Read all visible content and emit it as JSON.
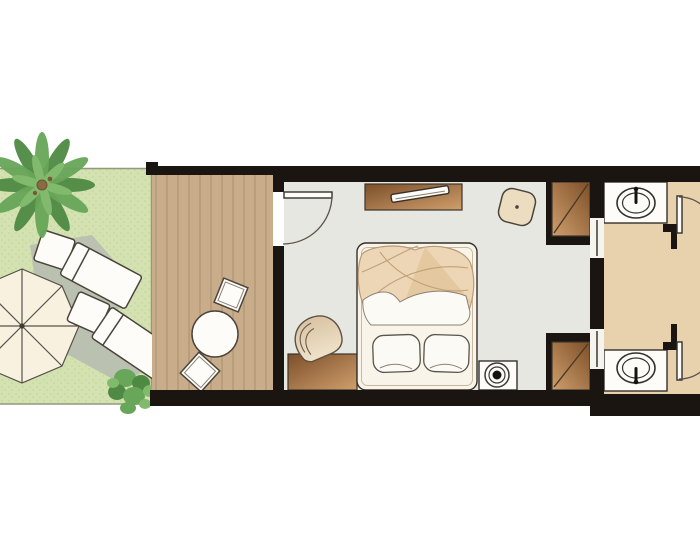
{
  "meta": {
    "type": "hotel-room-floor-plan",
    "width": 700,
    "height": 560,
    "visible_text": ""
  },
  "colors": {
    "background": "#ffffff",
    "wall": "#1b1512",
    "garden": "#d3e2b0",
    "garden_dot": "#c3d69c",
    "garden_edge": "#8f9b7e",
    "deck": "#c9ad8a",
    "deck_plank_line": "#a8906e",
    "bedroom_floor": "#e6e7e0",
    "bathroom_floor": "#e8d2ae",
    "furniture_dark": "#7d4f29",
    "furniture_light": "#cf9f6c",
    "bed_base": "#f8f4ea",
    "duvet": "#ecd6b6",
    "duvet_fold": "#e3c59c",
    "linen_white": "#fcfaf4",
    "white_furniture": "#fdfcf8",
    "chair_dark": "#d9c3a2",
    "chair_light": "#f0e3cc",
    "pouf": "#ecdcc0",
    "parasol": "#f8f1df",
    "shadow": "#b9beb2",
    "palm_dark": "#4f8a44",
    "palm_mid": "#68a659",
    "palm_light": "#82ba6d",
    "trunk": "#8a6a42",
    "panel_gap": "#f6f4ef",
    "lamp_black": "#151310"
  },
  "rooms": [
    {
      "name": "garden"
    },
    {
      "name": "deck-terrace"
    },
    {
      "name": "bedroom"
    },
    {
      "name": "bathroom-top"
    },
    {
      "name": "bathroom-bottom"
    }
  ],
  "furniture": [
    {
      "name": "palm-tree",
      "room": "garden"
    },
    {
      "name": "parasol-umbrella",
      "room": "garden"
    },
    {
      "name": "sun-lounger-1",
      "room": "garden"
    },
    {
      "name": "sun-lounger-2",
      "room": "garden"
    },
    {
      "name": "shrub",
      "room": "garden"
    },
    {
      "name": "round-table",
      "room": "deck-terrace"
    },
    {
      "name": "stool-1",
      "room": "deck-terrace"
    },
    {
      "name": "stool-2",
      "room": "deck-terrace"
    },
    {
      "name": "entrance-door",
      "room": "bedroom"
    },
    {
      "name": "console-with-tv",
      "room": "bedroom"
    },
    {
      "name": "pouf",
      "room": "bedroom"
    },
    {
      "name": "wardrobe-top",
      "room": "bedroom"
    },
    {
      "name": "wardrobe-bottom",
      "room": "bedroom"
    },
    {
      "name": "desk",
      "room": "bedroom"
    },
    {
      "name": "desk-chair",
      "room": "bedroom"
    },
    {
      "name": "double-bed",
      "room": "bedroom"
    },
    {
      "name": "bedside-lamp-table",
      "room": "bedroom"
    },
    {
      "name": "washbasin-top",
      "room": "bathroom-top"
    },
    {
      "name": "washbasin-bottom",
      "room": "bathroom-bottom"
    },
    {
      "name": "bathroom-door-top",
      "room": "bathroom-top"
    },
    {
      "name": "bathroom-door-bottom",
      "room": "bathroom-bottom"
    }
  ]
}
